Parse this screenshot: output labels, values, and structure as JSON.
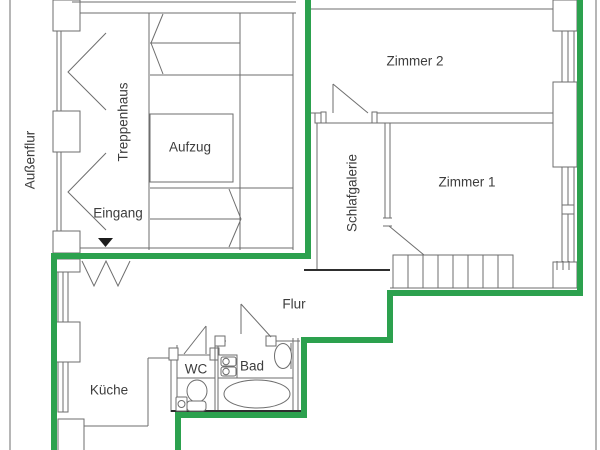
{
  "title": "Wohnungsgrundriss",
  "colors": {
    "boundary_green": "#2CA14E",
    "wall_gray": "#6e6e6e",
    "dark_line": "#2e2e2e",
    "text": "#3d3d3d",
    "background": "#ffffff"
  },
  "rooms": {
    "aussenflur": {
      "label": "Außenflur"
    },
    "treppenhaus": {
      "label": "Treppenhaus"
    },
    "aufzug": {
      "label": "Aufzug"
    },
    "eingang": {
      "label": "Eingang"
    },
    "zimmer2": {
      "label": "Zimmer 2"
    },
    "zimmer1": {
      "label": "Zimmer 1"
    },
    "schlafgalerie": {
      "label": "Schlafgalerie"
    },
    "flur": {
      "label": "Flur"
    },
    "kueche": {
      "label": "Küche"
    },
    "wc": {
      "label": "WC"
    },
    "bad": {
      "label": "Bad"
    }
  }
}
